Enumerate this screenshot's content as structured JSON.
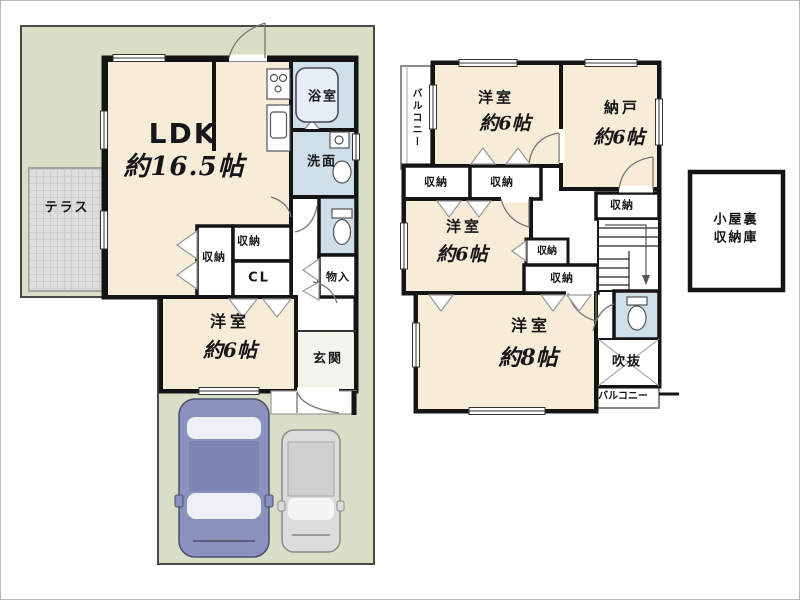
{
  "plan_type": "floorplan",
  "colors": {
    "lot_green": "#d8dfc6",
    "room_cream": "#f6ecd8",
    "wet_area_blue": "#cfdfe9",
    "wall_black": "#141414",
    "terrace_gray": "#dedede",
    "car_blue": "#8a92bd",
    "car_gray": "#dcdcdc"
  },
  "floor1": {
    "ldk": {
      "name": "LDK",
      "size": "約16.5帖"
    },
    "terrace": "テラス",
    "bathroom": "浴室",
    "washroom": "洗面",
    "storage_a": "収納",
    "storage_b": "収納",
    "closet": "CL",
    "storage_c": "物入",
    "bedroom": {
      "name": "洋室",
      "size": "約6帖"
    },
    "entrance": "玄関"
  },
  "floor2": {
    "balcony_left": "バルコニー",
    "bedroom_top": {
      "name": "洋室",
      "size": "約6帖"
    },
    "storeroom": {
      "name": "納戸",
      "size": "約6帖"
    },
    "storage_a": "収納",
    "storage_b": "収納",
    "storage_c": "収納",
    "storage_d": "収納",
    "storage_e": "収納",
    "bedroom_mid": {
      "name": "洋室",
      "size": "約6帖"
    },
    "bedroom_bottom": {
      "name": "洋室",
      "size": "約8帖"
    },
    "void": "吹抜",
    "balcony_bottom": "バルコニー"
  },
  "attic": {
    "line1": "小屋裏",
    "line2": "収納庫"
  }
}
